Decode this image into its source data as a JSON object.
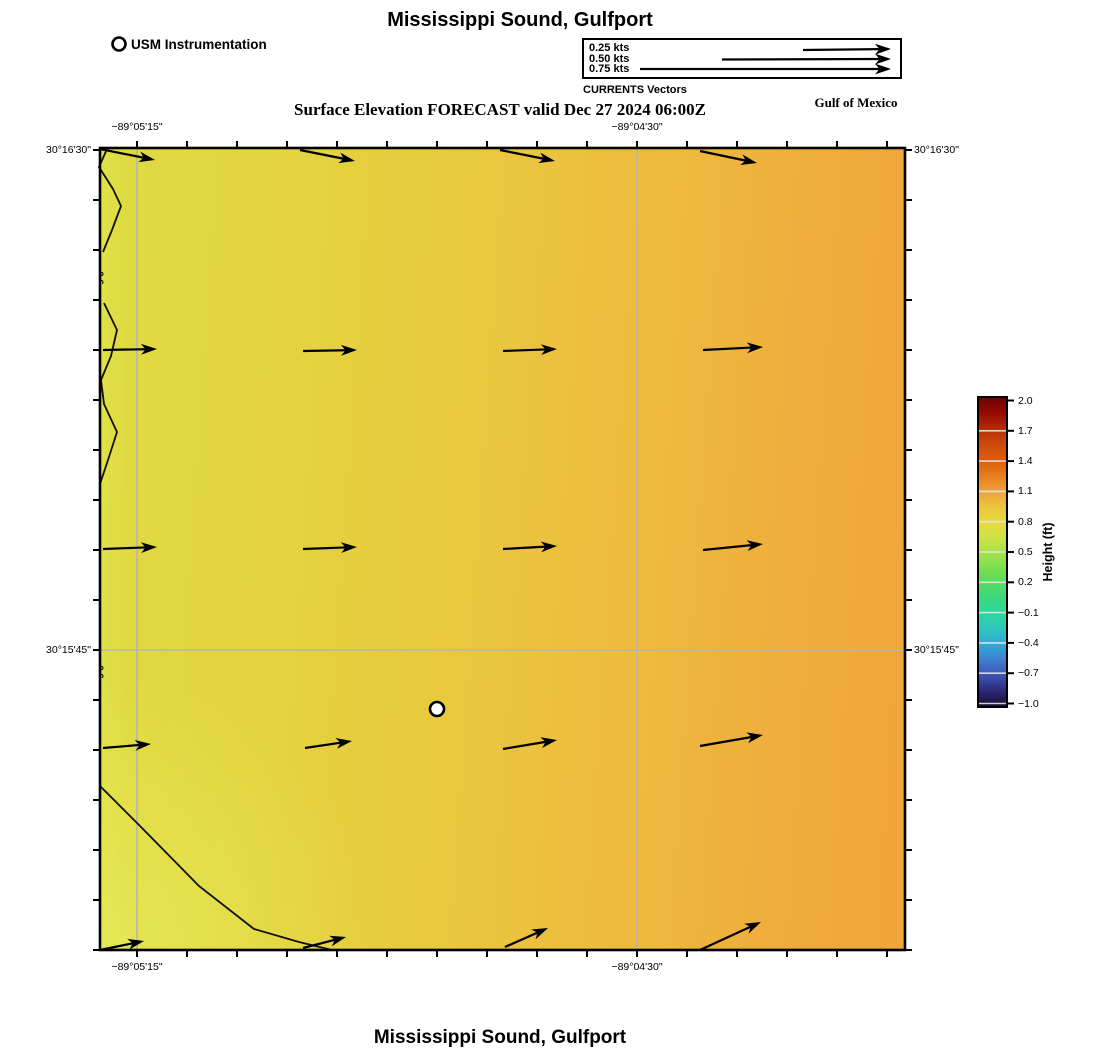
{
  "titles": {
    "top": "Mississippi Sound, Gulfport",
    "bottom": "Mississippi Sound, Gulfport",
    "subtitle": "Surface Elevation FORECAST valid Dec 27 2024 06:00Z",
    "region": "Gulf of Mexico"
  },
  "legend": {
    "instrumentation": "USM Instrumentation",
    "currents_caption": "CURRENTS Vectors",
    "entries": [
      {
        "label": "0.25 kts"
      },
      {
        "label": "0.50 kts"
      },
      {
        "label": "0.75 kts"
      }
    ]
  },
  "axes": {
    "x_top": [
      {
        "text": "−89°05'15\"",
        "x": 137
      },
      {
        "text": "−89°04'30\"",
        "x": 637
      }
    ],
    "x_bottom": [
      {
        "text": "−89°05'15\"",
        "x": 137
      },
      {
        "text": "−89°04'30\"",
        "x": 637
      }
    ],
    "y_left": [
      {
        "text": "30°16'30\"",
        "y": 150
      },
      {
        "text": "30°15'45\"",
        "y": 650
      }
    ],
    "y_right": [
      {
        "text": "30°16'30\"",
        "y": 150
      },
      {
        "text": "30°15'45\"",
        "y": 650
      }
    ],
    "xticks": [
      137,
      187,
      237,
      287,
      337,
      387,
      437,
      487,
      537,
      587,
      637,
      687,
      737,
      787,
      837,
      887
    ],
    "yticks": [
      150,
      200,
      250,
      300,
      350,
      400,
      450,
      500,
      550,
      600,
      650,
      700,
      750,
      800,
      850,
      900,
      950
    ]
  },
  "colorbar": {
    "title": "Height (ft)",
    "tick_labels": [
      "2.0",
      "1.7",
      "1.4",
      "1.1",
      "0.8",
      "0.5",
      "0.2",
      "−0.1",
      "−0.4",
      "−0.7",
      "−1.0"
    ]
  },
  "map": {
    "frame": {
      "x": 100,
      "y": 148,
      "w": 805,
      "h": 802
    },
    "gridlines": {
      "v": [
        137,
        637
      ],
      "h": [
        650
      ]
    },
    "contours": [
      {
        "points": [
          [
            107,
            149
          ],
          [
            99,
            167
          ],
          [
            113,
            189
          ],
          [
            121,
            206
          ],
          [
            112,
            230
          ],
          [
            103,
            252
          ]
        ]
      },
      {
        "points": [
          [
            104,
            303
          ],
          [
            117,
            330
          ],
          [
            111,
            356
          ],
          [
            101,
            380
          ],
          [
            104,
            404
          ],
          [
            117,
            432
          ],
          [
            108,
            460
          ],
          [
            100,
            484
          ]
        ]
      },
      {
        "points": [
          [
            100,
            786
          ],
          [
            141,
            827
          ],
          [
            199,
            886
          ],
          [
            254,
            929
          ],
          [
            299,
            942
          ],
          [
            332,
            950
          ]
        ]
      }
    ],
    "contour_labels": [
      {
        "text": "0.6",
        "x": 97,
        "y": 278
      },
      {
        "text": "0.6",
        "x": 97,
        "y": 672
      }
    ],
    "vectors": [
      {
        "x1": 100,
        "y1": 149,
        "x2": 155,
        "y2": 160
      },
      {
        "x1": 300,
        "y1": 150,
        "x2": 355,
        "y2": 161
      },
      {
        "x1": 500,
        "y1": 150,
        "x2": 555,
        "y2": 161
      },
      {
        "x1": 700,
        "y1": 151,
        "x2": 757,
        "y2": 163
      },
      {
        "x1": 103,
        "y1": 350,
        "x2": 157,
        "y2": 349
      },
      {
        "x1": 303,
        "y1": 351,
        "x2": 357,
        "y2": 350
      },
      {
        "x1": 503,
        "y1": 351,
        "x2": 557,
        "y2": 349
      },
      {
        "x1": 703,
        "y1": 350,
        "x2": 763,
        "y2": 347
      },
      {
        "x1": 103,
        "y1": 549,
        "x2": 157,
        "y2": 547
      },
      {
        "x1": 303,
        "y1": 549,
        "x2": 357,
        "y2": 547
      },
      {
        "x1": 503,
        "y1": 549,
        "x2": 557,
        "y2": 546
      },
      {
        "x1": 703,
        "y1": 550,
        "x2": 763,
        "y2": 544
      },
      {
        "x1": 103,
        "y1": 748,
        "x2": 151,
        "y2": 744
      },
      {
        "x1": 305,
        "y1": 748,
        "x2": 352,
        "y2": 741
      },
      {
        "x1": 503,
        "y1": 749,
        "x2": 557,
        "y2": 740
      },
      {
        "x1": 700,
        "y1": 746,
        "x2": 763,
        "y2": 735
      },
      {
        "x1": 100,
        "y1": 950,
        "x2": 144,
        "y2": 941
      },
      {
        "x1": 303,
        "y1": 948,
        "x2": 346,
        "y2": 937
      },
      {
        "x1": 505,
        "y1": 947,
        "x2": 548,
        "y2": 928
      },
      {
        "x1": 700,
        "y1": 950,
        "x2": 761,
        "y2": 922
      }
    ],
    "legend_vectors": [
      {
        "x1": 803,
        "y1": 50,
        "x2": 891,
        "y2": 49
      },
      {
        "x1": 722,
        "y1": 59.5,
        "x2": 891,
        "y2": 59
      },
      {
        "x1": 640,
        "y1": 69,
        "x2": 891,
        "y2": 69
      }
    ],
    "markers": [
      {
        "x": 437,
        "y": 709,
        "r": 7
      },
      {
        "x": 119,
        "y": 44,
        "r": 6.5
      }
    ]
  },
  "chart_data": {
    "type": "heatmap",
    "title": "Mississippi Sound, Gulfport",
    "subtitle": "Surface Elevation FORECAST valid Dec 27 2024 06:00Z",
    "field": "Surface elevation forecast with current vectors",
    "x_tick_labels": [
      "−89°05'15\"",
      "−89°04'30\""
    ],
    "y_tick_labels": [
      "30°16'30\"",
      "30°15'45\""
    ],
    "colorbar": {
      "label": "Height (ft)",
      "ticks": [
        2.0,
        1.7,
        1.4,
        1.1,
        0.8,
        0.5,
        0.2,
        -0.1,
        -0.4,
        -0.7,
        -1.0
      ],
      "range": [
        -1.0,
        2.0
      ]
    },
    "elevation_estimate_ft": {
      "west_side": 0.8,
      "east_side": 1.05,
      "contour_line_value": 0.6
    },
    "current_vectors": {
      "legend_speeds_kts": [
        0.25,
        0.5,
        0.75
      ],
      "grid": "4 columns x 5 rows",
      "direction": "eastward",
      "approx_speed_kts_range": [
        0.12,
        0.2
      ]
    },
    "station_marker": {
      "label": "USM Instrumentation",
      "approx_position": "center of domain, south of 30°15'45\""
    }
  }
}
